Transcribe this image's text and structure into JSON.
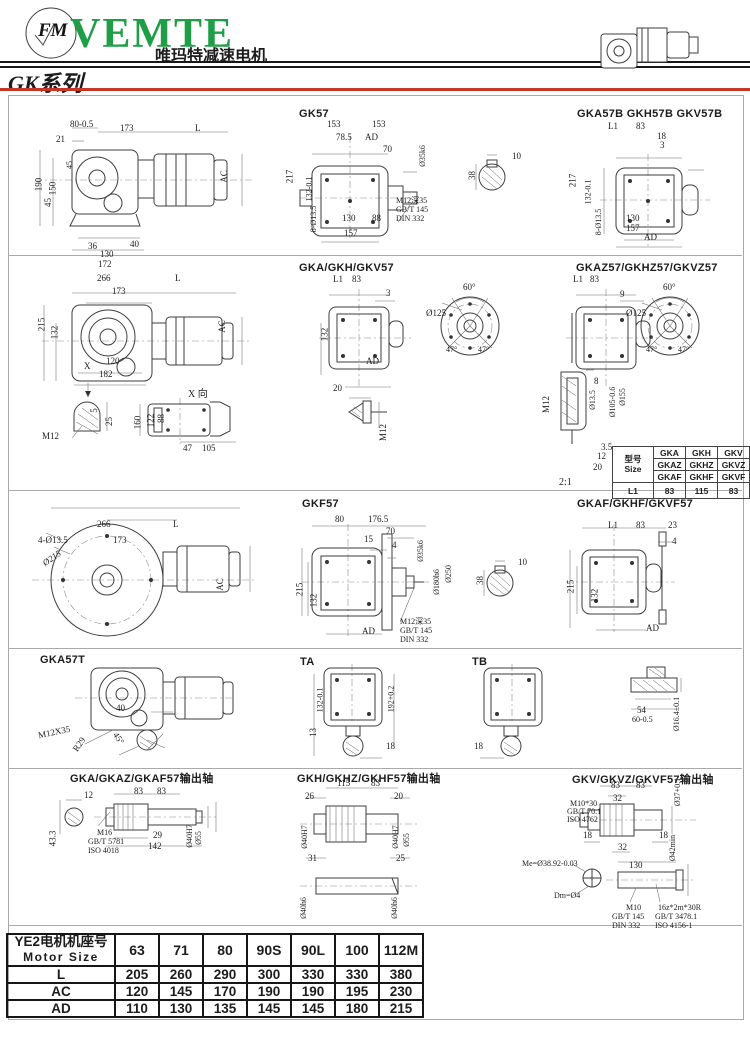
{
  "h": {
    "brand": "VEMTE",
    "cn": "唯玛特减速电机",
    "series": "GK系列",
    "logo": "FM"
  },
  "t": {
    "gk57": "GK57",
    "gk57b": "GKA57B GKH57B GKV57B",
    "gkahv": "GKA/GKH/GKV57",
    "gkaz": "GKAZ57/GKHZ57/GKVZ57",
    "xview": "X 向",
    "scale": "2:1",
    "gkf57": "GKF57",
    "gkaf": "GKAF/GKHF/GKVF57",
    "gka57t": "GKA57T",
    "ta": "TA",
    "tb": "TB",
    "outA": "GKA/GKAZ/GKAF57输出轴",
    "outH": "GKH/GKHZ/GKHF57输出轴",
    "outV": "GKV/GKVZ/GKVF57输出轴"
  },
  "p": {
    "r1a": [
      "80-0.5",
      "21",
      "173",
      "L",
      "190",
      "150",
      "45",
      "45",
      "36",
      "40",
      "130",
      "172",
      "AC"
    ],
    "gk57": [
      "153",
      "153",
      "78.5",
      "AD",
      "70",
      "Ø35k6",
      "217",
      "132-0.1",
      "8-Ø13.5",
      "130",
      "88",
      "157",
      "M12深35",
      "GB/T 145",
      "DIN 332"
    ],
    "key1": [
      "10",
      "38"
    ],
    "gk57b": [
      "L1",
      "83",
      "18",
      "3",
      "217",
      "132-0.1",
      "8-Ø13.5",
      "130",
      "157",
      "AD"
    ],
    "r2a": [
      "266",
      "173",
      "L",
      "215",
      "132",
      "120",
      "182",
      "AC",
      "X"
    ],
    "gkahv": [
      "L1",
      "83",
      "3",
      "132",
      "AD"
    ],
    "tip": [
      "20",
      "M12"
    ],
    "flange1": [
      "Ø125",
      "60°",
      "47°",
      "47°"
    ],
    "gkaz": [
      "L1",
      "83",
      "9"
    ],
    "flange2": [
      "Ø125",
      "60°",
      "47°",
      "47°"
    ],
    "keyway": [
      "M12",
      "5",
      "25"
    ],
    "xview": [
      "160",
      "122",
      "88",
      "47",
      "105"
    ],
    "hollow": [
      "8",
      "M12",
      "Ø13.5",
      "Ø105-0.6",
      "Ø155",
      "3.5",
      "12",
      "20"
    ],
    "r3a": [
      "266",
      "L",
      "4-Ø13.5",
      "173",
      "Ø215",
      "AC"
    ],
    "gkf57": [
      "80",
      "176.5",
      "70",
      "15",
      "4",
      "Ø35k6",
      "Ø180h6",
      "Ø250",
      "215",
      "132",
      "AD",
      "M12深35",
      "GB/T 145",
      "DIN 332"
    ],
    "key2": [
      "10",
      "38"
    ],
    "gkaf": [
      "L1",
      "83",
      "23",
      "4",
      "215",
      "132",
      "AD"
    ],
    "gka57t": [
      "40",
      "M12X35",
      "R29",
      "45°"
    ],
    "ta": [
      "132-0.1",
      "192+0.2",
      "13",
      "18"
    ],
    "tb": [
      "18"
    ],
    "bush": [
      "54",
      "60-0.5",
      "Ø16.4±0.1"
    ],
    "outA": [
      "12",
      "83",
      "83",
      "43.3",
      "M16",
      "GB/T 5781",
      "ISO 4018",
      "29",
      "142",
      "Ø40H7",
      "Ø55"
    ],
    "outH": [
      "26",
      "115",
      "83",
      "20",
      "Ø40H7",
      "Ø40H7",
      "Ø55",
      "31",
      "25",
      "Ø40h6",
      "Ø40h6"
    ],
    "outV": [
      "83",
      "83",
      "32",
      "Ø37+0.1",
      "M10*30",
      "GB/T 70.1",
      "ISO 4762",
      "18",
      "18",
      "32",
      "Ø42min",
      "Me=Ø38.92-0.03",
      "Dm=Ø4",
      "130",
      "M10",
      "GB/T 145",
      "DIN 332",
      "16z*2m*30R",
      "GB/T 3478.1",
      "ISO 4156-1"
    ]
  },
  "st": {
    "h1": "型号",
    "h2": "Size",
    "r1": [
      "GKA",
      "GKH",
      "GKV"
    ],
    "r2": [
      "GKAZ",
      "GKHZ",
      "GKVZ"
    ],
    "r3": [
      "GKAF",
      "GKHF",
      "GKVF"
    ],
    "r4": [
      "L1",
      "83",
      "115",
      "83"
    ]
  },
  "mt": {
    "h_cn": "YE2电机机座号",
    "h_en": "Motor Size",
    "cols": [
      "63",
      "71",
      "80",
      "90S",
      "90L",
      "100",
      "112M"
    ],
    "rows": [
      {
        "l": "L",
        "v": [
          "205",
          "260",
          "290",
          "300",
          "330",
          "330",
          "380"
        ]
      },
      {
        "l": "AC",
        "v": [
          "120",
          "145",
          "170",
          "190",
          "190",
          "195",
          "230"
        ]
      },
      {
        "l": "AD",
        "v": [
          "110",
          "130",
          "135",
          "145",
          "145",
          "180",
          "215"
        ]
      }
    ]
  },
  "colors": {
    "accent_red": "#c63527",
    "brand_green": "#1f9e47",
    "logo_yellow": "#f7d51c"
  }
}
